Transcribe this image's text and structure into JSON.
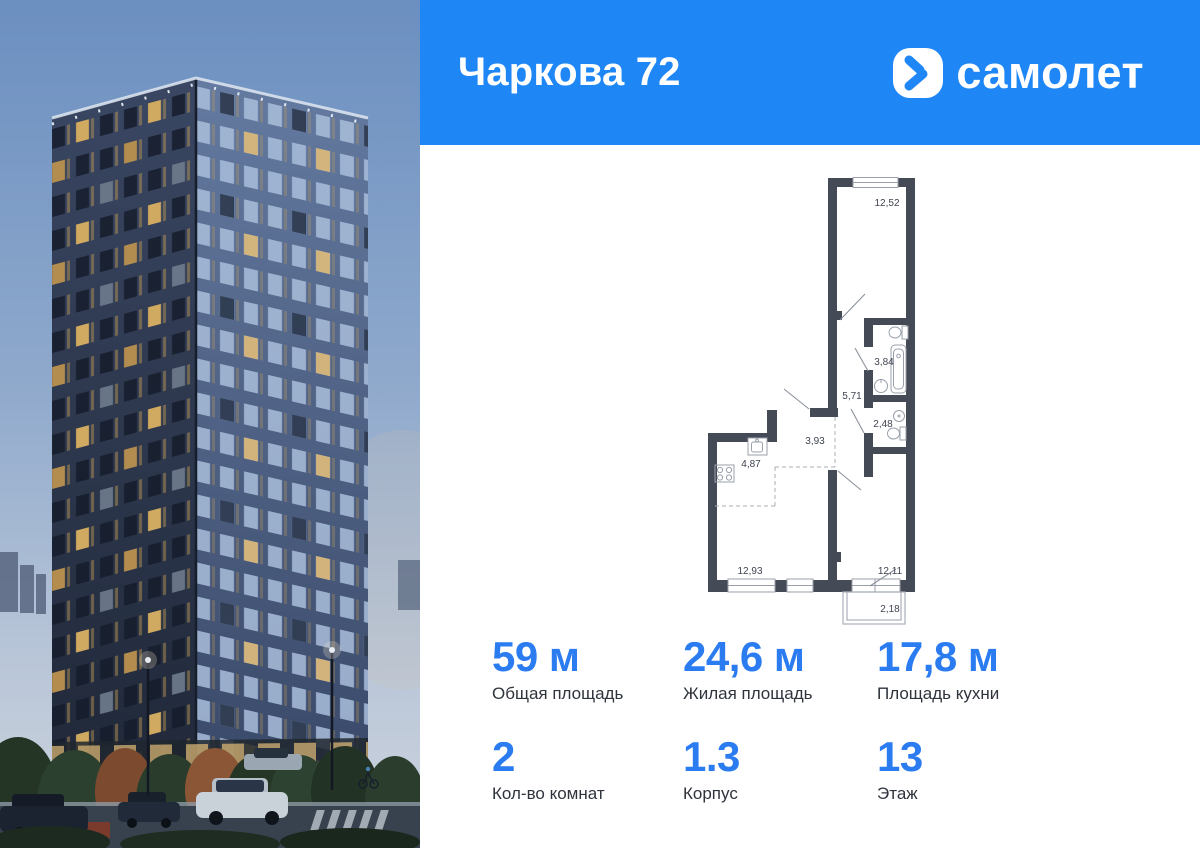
{
  "header": {
    "title": "Чаркова 72",
    "brand": "самолет"
  },
  "floorplan": {
    "rooms": [
      {
        "area": "12,52"
      },
      {
        "area": "3,84"
      },
      {
        "area": "5,71"
      },
      {
        "area": "2,48"
      },
      {
        "area": "3,93"
      },
      {
        "area": "4,87"
      },
      {
        "area": "12,93"
      },
      {
        "area": "12,11"
      },
      {
        "area": "2,18"
      }
    ]
  },
  "stats": {
    "row1": [
      {
        "value": "59 м",
        "label": "Общая площадь"
      },
      {
        "value": "24,6 м",
        "label": "Жилая площадь"
      },
      {
        "value": "17,8 м",
        "label": "Площадь кухни"
      }
    ],
    "row2": [
      {
        "value": "2",
        "label": "Кол-во комнат"
      },
      {
        "value": "1.3",
        "label": "Корпус"
      },
      {
        "value": "13",
        "label": "Этаж"
      }
    ]
  },
  "colors": {
    "accent": "#1f86f5",
    "value_blue": "#2b7cf0",
    "wall": "#454a57"
  }
}
